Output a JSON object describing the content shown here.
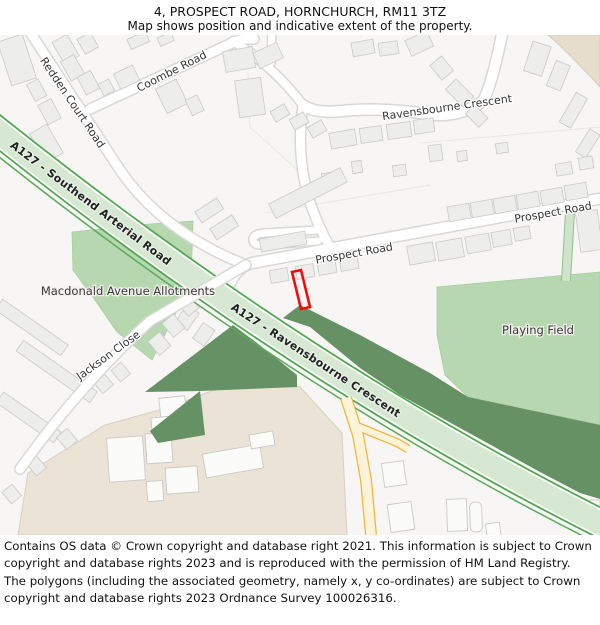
{
  "header": {
    "title": "4, PROSPECT ROAD, HORNCHURCH, RM11 3TZ",
    "subtitle": "Map shows position and indicative extent of the property."
  },
  "map": {
    "labels": {
      "coombe_road": "Coombe Road",
      "redden_court_road": "Redden Court Road",
      "ravensbourne_crescent": "Ravensbourne Crescent",
      "prospect_road_left": "Prospect Road",
      "prospect_road_right": "Prospect Road",
      "a127_southend": "A127 - Southend Arterial Road",
      "a127_ravensbourne": "A127 - Ravensbourne Crescent",
      "macdonald_allotments": "Macdonald Avenue Allotments",
      "jackson_close": "Jackson Close",
      "playing_field": "Playing Field"
    },
    "colors": {
      "background": "#f7f6f4",
      "building": "#ededeb",
      "building_edge": "#c9c9c7",
      "road_white": "#ffffff",
      "road_casing": "#d8d8d6",
      "a127_fill": "#d6e8d1",
      "a127_edge": "#4ea74e",
      "green_light": "#b7d7b0",
      "green_dark": "#659165",
      "beige": "#eae3d6",
      "yellow_fill": "#fcf3d8",
      "yellow_edge": "#f0b53c",
      "property_outline": "#ee0d0d"
    }
  },
  "footer": {
    "copyright": "Contains OS data © Crown copyright and database right 2021. This information is subject to Crown copyright and database rights 2023 and is reproduced with the permission of HM Land Registry. The polygons (including the associated geometry, namely x, y co-ordinates) are subject to Crown copyright and database rights 2023 Ordnance Survey 100026316."
  }
}
